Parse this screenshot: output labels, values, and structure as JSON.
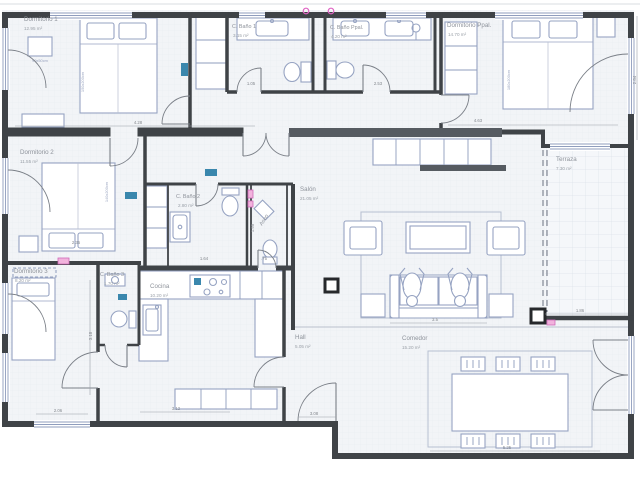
{
  "title": "Floor plan",
  "palette": {
    "wall": "#3f4347",
    "wall_band": "#565b61",
    "furniture": "#96a3c2",
    "floor": "#f2f4f7",
    "terrace_floor": "#f5f7fa",
    "label_text": "#8e939b",
    "dim_text": "#85898f",
    "marker_blue": "#3a87ad",
    "accent_magenta": "#df63c3",
    "accent_pink": "#f2b3dd"
  },
  "rooms": [
    {
      "name": "Dormitorio 1",
      "area": "12.95 m²"
    },
    {
      "name": "C. Baño 1",
      "area": "3.15 m²"
    },
    {
      "name": "C. Baño Ppal.",
      "area": "4.20 m²"
    },
    {
      "name": "Dormitorio Ppal.",
      "area": "14.70 m²"
    },
    {
      "name": "Dormitorio 2",
      "area": "11.55 m²"
    },
    {
      "name": "Terraza",
      "area": "7.30 m²"
    },
    {
      "name": "Salón",
      "area": "21.05 m²"
    },
    {
      "name": "C. Baño 2",
      "area": "2.80 m²"
    },
    {
      "name": "Aseo",
      "area": ""
    },
    {
      "name": "Dormitorio 3",
      "area": "8.20 m²"
    },
    {
      "name": "C. Baño 3",
      "area": "1.70 m²"
    },
    {
      "name": "Cocina",
      "area": "10.20 m²"
    },
    {
      "name": "Hall",
      "area": "5.05 m²"
    },
    {
      "name": "Comedor",
      "area": "15.20 m²"
    }
  ],
  "furniture_labels": [
    {
      "text": "150x200cm"
    },
    {
      "text": "90x50cm"
    },
    {
      "text": "140x200cm"
    },
    {
      "text": "180x200cm"
    }
  ],
  "dimensions": [
    {
      "text": "4.28"
    },
    {
      "text": "1.05"
    },
    {
      "text": "2.53"
    },
    {
      "text": "4.63"
    },
    {
      "text": "2.84"
    },
    {
      "text": "2.35"
    },
    {
      "text": "1.64"
    },
    {
      "text": ".75"
    },
    {
      "text": "3.12"
    },
    {
      "text": "3.08"
    },
    {
      "text": "5.25"
    },
    {
      "text": "1.86"
    },
    {
      "text": "2.06"
    },
    {
      "text": "3.5"
    },
    {
      "text": "3.18"
    },
    {
      "text": "1.95"
    }
  ]
}
